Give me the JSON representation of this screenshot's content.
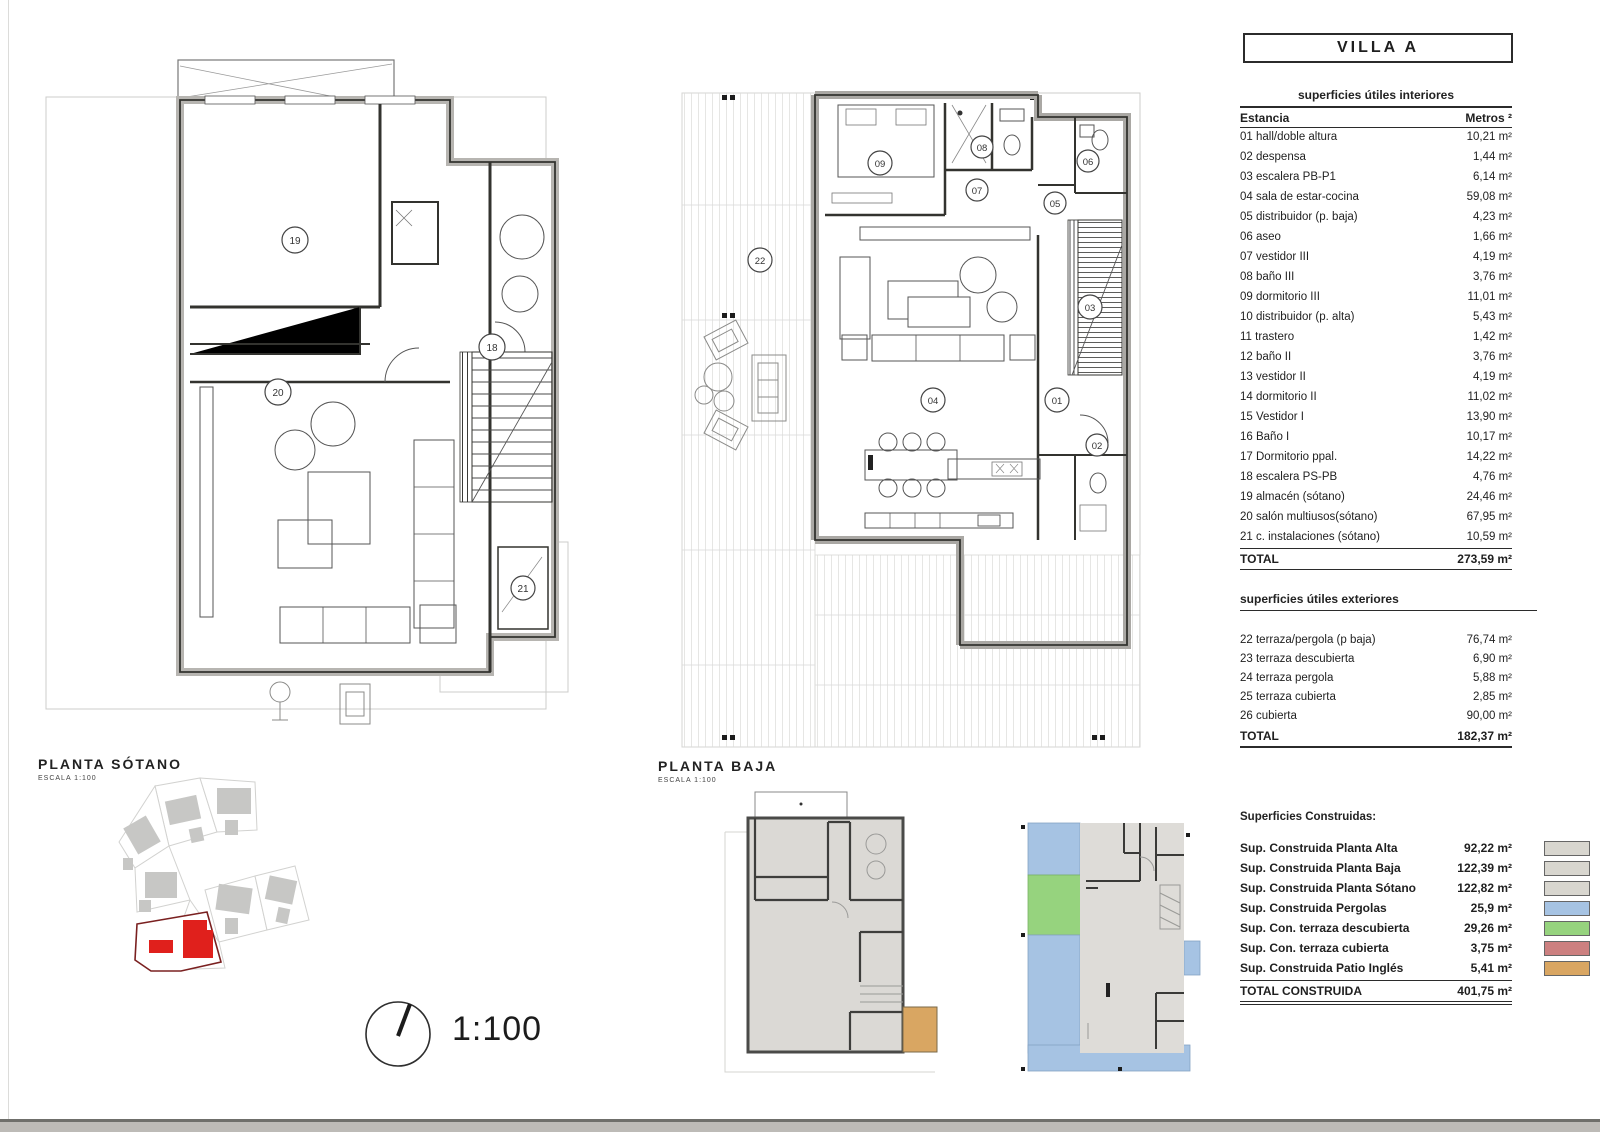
{
  "sheet": {
    "title": "VILLA A",
    "scale_label": "1:100"
  },
  "plans": {
    "sotano": {
      "label": "PLANTA SÓTANO",
      "sublabel": "ESCALA 1:100",
      "badges": [
        "19",
        "18",
        "20",
        "21"
      ]
    },
    "baja": {
      "label": "PLANTA BAJA",
      "sublabel": "ESCALA 1:100",
      "badges": [
        "09",
        "08",
        "07",
        "06",
        "05",
        "03",
        "22",
        "04",
        "01",
        "02"
      ]
    }
  },
  "interior_table": {
    "title": "superficies útiles interiores",
    "col_room": "Estancia",
    "col_area": "Metros ²",
    "rows": [
      {
        "label": "01 hall/doble altura",
        "value": "10,21 m²"
      },
      {
        "label": "02 despensa",
        "value": "1,44 m²"
      },
      {
        "label": "03 escalera PB-P1",
        "value": "6,14 m²"
      },
      {
        "label": "04 sala de estar-cocina",
        "value": "59,08 m²"
      },
      {
        "label": "05 distribuidor (p. baja)",
        "value": "4,23 m²"
      },
      {
        "label": "06 aseo",
        "value": "1,66 m²"
      },
      {
        "label": "07 vestidor III",
        "value": "4,19 m²"
      },
      {
        "label": "08 baño III",
        "value": "3,76 m²"
      },
      {
        "label": "09 dormitorio III",
        "value": "11,01 m²"
      },
      {
        "label": "10 distribuidor (p. alta)",
        "value": "5,43 m²"
      },
      {
        "label": "11 trastero",
        "value": "1,42 m²"
      },
      {
        "label": "12 baño II",
        "value": "3,76 m²"
      },
      {
        "label": "13 vestidor II",
        "value": "4,19 m²"
      },
      {
        "label": "14 dormitorio II",
        "value": "11,02 m²"
      },
      {
        "label": "15 Vestidor I",
        "value": "13,90 m²"
      },
      {
        "label": "16 Baño I",
        "value": "10,17 m²"
      },
      {
        "label": "17 Dormitorio ppal.",
        "value": "14,22 m²"
      },
      {
        "label": "18 escalera PS-PB",
        "value": "4,76 m²"
      },
      {
        "label": "19 almacén (sótano)",
        "value": "24,46 m²"
      },
      {
        "label": "20 salón multiusos(sótano)",
        "value": "67,95 m²"
      },
      {
        "label": "21 c. instalaciones (sótano)",
        "value": "10,59 m²"
      }
    ],
    "total_label": "TOTAL",
    "total_value": "273,59 m²"
  },
  "exterior_table": {
    "title": "superficies útiles exteriores",
    "rows": [
      {
        "label": "22 terraza/pergola (p baja)",
        "value": "76,74 m²"
      },
      {
        "label": "23 terraza descubierta",
        "value": "6,90 m²"
      },
      {
        "label": "24 terraza pergola",
        "value": "5,88 m²"
      },
      {
        "label": "25 terraza cubierta",
        "value": "2,85 m²"
      },
      {
        "label": "26 cubierta",
        "value": "90,00 m²"
      }
    ],
    "total_label": "TOTAL",
    "total_value": "182,37 m²"
  },
  "built_table": {
    "title": "Superficies Construidas:",
    "rows": [
      {
        "label": "Sup. Construida Planta Alta",
        "value": "92,22 m²",
        "color": "#d8d6cf"
      },
      {
        "label": "Sup. Construida Planta Baja",
        "value": "122,39 m²",
        "color": "#d8d6cf"
      },
      {
        "label": "Sup. Construida Planta Sótano",
        "value": "122,82 m²",
        "color": "#d8d6cf"
      },
      {
        "label": "Sup. Construida Pergolas",
        "value": "25,9 m²",
        "color": "#a6c3e3"
      },
      {
        "label": "Sup. Con. terraza descubierta",
        "value": "29,26 m²",
        "color": "#96d37e"
      },
      {
        "label": "Sup. Con. terraza cubierta",
        "value": "3,75 m²",
        "color": "#cc8080"
      },
      {
        "label": "Sup. Construida Patio Inglés",
        "value": "5,41 m²",
        "color": "#d9a662"
      }
    ],
    "total_label": "TOTAL CONSTRUIDA",
    "total_value": "401,75 m²"
  },
  "colors": {
    "highlight_plot_red": "#e0201c",
    "plot_boundary_red": "#7a2020",
    "pergola_blue": "#a6c3e3",
    "terrace_green": "#96d37e",
    "terrace_pink": "#cc8080",
    "patio_tan": "#d9a662",
    "built_gray": "#d8d6cf"
  }
}
